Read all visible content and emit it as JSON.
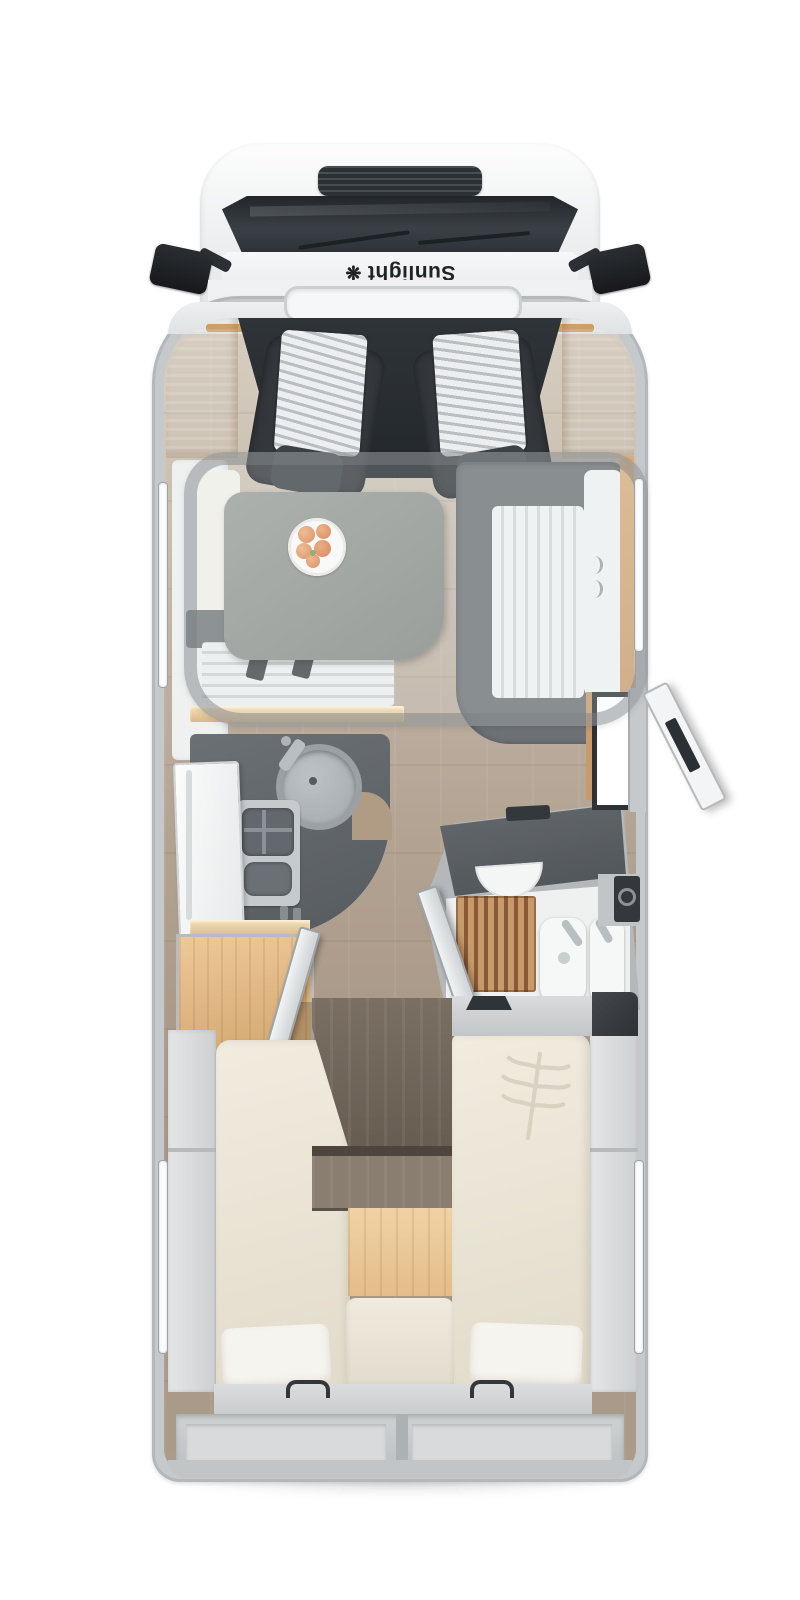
{
  "brand": {
    "logo_text": "Sunlight"
  },
  "icons": {
    "flower_logo_icon": "❋"
  },
  "theme": {
    "background": "#ffffff",
    "wall": "#c6c9cb",
    "interiorFloor": "#b3a393",
    "counter": "#565b5f",
    "seat": "#34383c",
    "table": "#90948f",
    "cushion": "#f0ece3",
    "wood": "#d9ad7e",
    "oak": "#ecca9e",
    "teak": "#a9734a",
    "mattress": "#ebe5d8",
    "glass": "#2e3338",
    "fixture_white": "#f6f8f8"
  }
}
